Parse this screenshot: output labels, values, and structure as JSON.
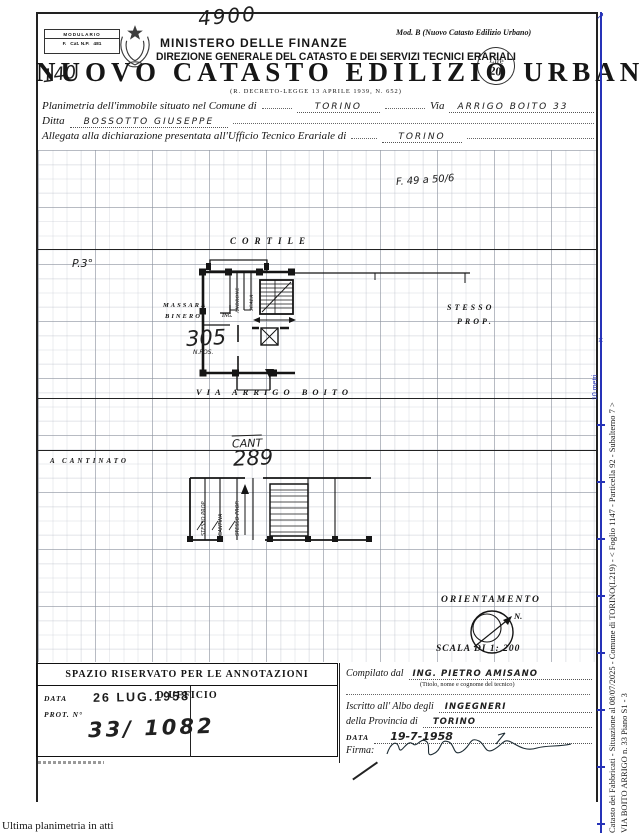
{
  "header": {
    "modulario1": "MODULARIO",
    "modulario2": "F.   Cat. N.P.   481",
    "hand_top": "4900",
    "ministry": "MINISTERO DELLE FINANZE",
    "direction": "DIREZIONE GENERALE DEL CATASTO E DEI SERVIZI TECNICI ERARIALI",
    "mod_b": "Mod. B (Nuovo Catasto Edilizio Urbano)",
    "lire1": "Lire",
    "lire2": "20",
    "hand_140": "140",
    "title": "NUOVO CATASTO EDILIZIO URBANO",
    "subtitle": "(R. DECRETO-LEGGE 13 APRILE 1939, N. 652)"
  },
  "form": {
    "l1a": "Planimetria dell'immobile situato nel Comune di",
    "l1v1": "TORINO",
    "l1b": "Via",
    "l1v2": "ARRIGO BOITO 33",
    "l2a": "Ditta",
    "l2v": "BOSSOTTO GIUSEPPE",
    "l3a": "Allegata alla dichiarazione presentata all'Ufficio Tecnico Erariale di",
    "l3v": "TORINO"
  },
  "plan": {
    "sheet_ref": "F. 49 a 50/6",
    "cortile": "CORTILE",
    "floor": "P.3°",
    "neighbor1": "MASSARA",
    "neighbor2": "BINERO",
    "androne": "ANDRONE",
    "scala": "SCALA",
    "ing": "ING.",
    "unit": "305",
    "unit_sub": "N.POS.",
    "sp1": "STESSO",
    "sp2": "PROP.",
    "street": "VIA ARRIGO BOITO"
  },
  "basement": {
    "cant": "CANT",
    "num": "289",
    "left_label": "A CANTINATO",
    "m1": "STESSO PROP.",
    "m2": "CANTINA",
    "m3": "STESSO PROP."
  },
  "orient": {
    "title": "ORIENTAMENTO",
    "north": "N.",
    "scale": "SCALA DI 1: 200"
  },
  "annot": {
    "title": "SPAZIO RISERVATO PER LE ANNOTAZIONI D'UFFICIO",
    "data_label": "DATA",
    "prot_label": "PROT. N°",
    "stamp": "26 LUG.1958",
    "number": "33/ 1082"
  },
  "comp": {
    "c_label": "Compilato dal",
    "c_value": "ING. PIETRO AMISANO",
    "c_sub": "(Titolo, nome e cognome del tecnico)",
    "albo_label": "Iscritto all' Albo degli",
    "albo_value": "INGEGNERI",
    "prov_label": "della Provincia di",
    "prov_value": "TORINO",
    "data_label": "DATA",
    "data_value": "19-7-1958",
    "firma": "Firma:"
  },
  "side": {
    "l1": "Catasto dei Fabbricati - Situazione al 08/07/2025 - Comune di TORINO(L219) - <  Foglio 1147 - Particella 92 - Subalterno 7 >",
    "l2": "VIA BOITO ARRIGO n. 33 Piano S1 - 3",
    "ruler": "10 metri",
    "ruler_color": "#2633b8"
  },
  "footer": {
    "text": "Ultima planimetria in atti"
  }
}
